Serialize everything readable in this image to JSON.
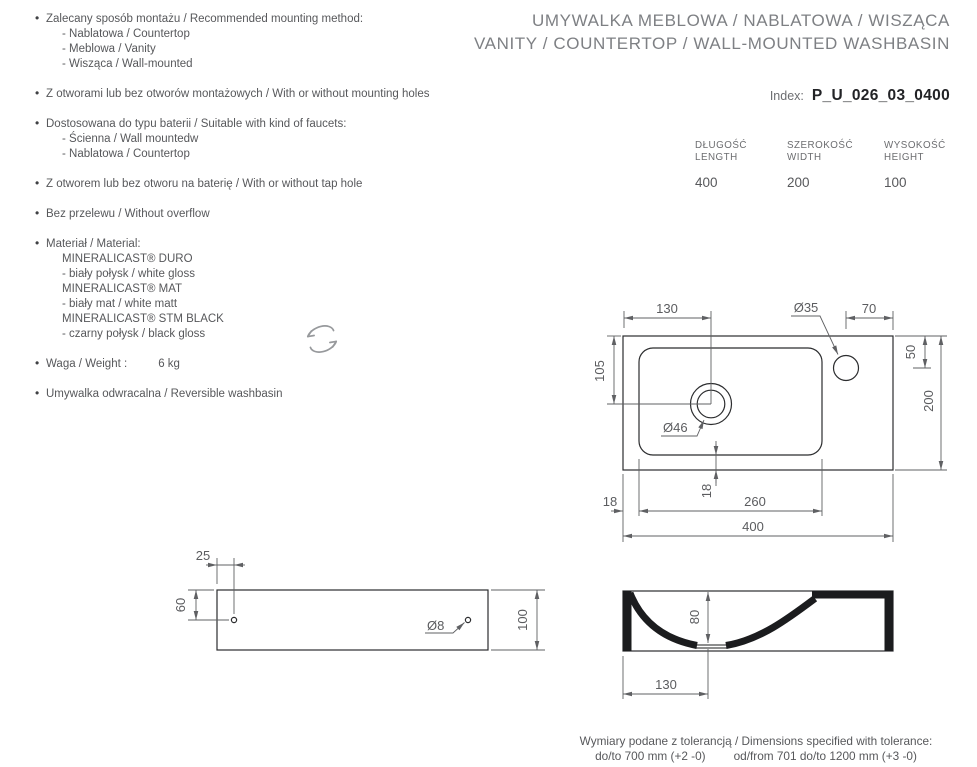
{
  "header": {
    "title_line1": "UMYWALKA MEBLOWA / NABLATOWA / WISZĄCA",
    "title_line2": "VANITY / COUNTERTOP / WALL-MOUNTED WASHBASIN",
    "index_label": "Index:",
    "index_value": "P_U_026_03_0400"
  },
  "features": [
    {
      "text": "Zalecany sposób montażu / Recommended mounting method:",
      "subitems": [
        "- Nablatowa / Countertop",
        "- Meblowa / Vanity",
        "- Wisząca / Wall-mounted"
      ]
    },
    {
      "text": "Z otworami lub bez otworów montażowych / With or without mounting holes",
      "subitems": []
    },
    {
      "text": "Dostosowana do typu baterii / Suitable with kind of faucets:",
      "subitems": [
        "- Ścienna / Wall mountedw",
        "- Nablatowa / Countertop"
      ]
    },
    {
      "text": "Z otworem lub bez otworu na baterię / With or without tap hole",
      "subitems": []
    },
    {
      "text": "Bez przelewu / Without overflow",
      "subitems": []
    },
    {
      "text": "Materiał / Material:",
      "subitems": [
        "MINERALICAST® DURO",
        "- biały połysk / white gloss",
        "MINERALICAST® MAT",
        "- biały mat / white matt",
        "MINERALICAST® STM BLACK",
        "- czarny połysk / black gloss"
      ]
    },
    {
      "text": "Waga / Weight :",
      "value": "6 kg",
      "subitems": []
    },
    {
      "text": "Umywalka odwracalna / Reversible washbasin",
      "subitems": []
    }
  ],
  "dimensions_table": {
    "columns": [
      {
        "label_pl": "DŁUGOŚĆ",
        "label_en": "LENGTH",
        "value": "400"
      },
      {
        "label_pl": "SZEROKOŚĆ",
        "label_en": "WIDTH",
        "value": "200"
      },
      {
        "label_pl": "WYSOKOŚĆ",
        "label_en": "HEIGHT",
        "value": "100"
      }
    ]
  },
  "drawings": {
    "top_view": {
      "drain_offset_x": "130",
      "tap_diameter": "Ø35",
      "tap_edge_offset": "70",
      "drain_offset_y": "105",
      "tap_offset_y": "50",
      "total_width": "200",
      "drain_diameter": "Ø46",
      "rim_gap_left": "18",
      "rim_gap_bottom": "18",
      "basin_length": "260",
      "total_length": "400"
    },
    "rear_view": {
      "hole_offset_x": "25",
      "hole_offset_y": "60",
      "total_height": "100",
      "hole_diameter": "Ø8"
    },
    "section_view": {
      "bowl_depth": "80",
      "drain_offset": "130"
    }
  },
  "footer": {
    "line1": "Wymiary podane z tolerancją / Dimensions specified with tolerance:",
    "line2_left": "do/to 700 mm (+2 -0)",
    "line2_right": "od/from 701 do/to 1200 mm (+3 -0)"
  }
}
